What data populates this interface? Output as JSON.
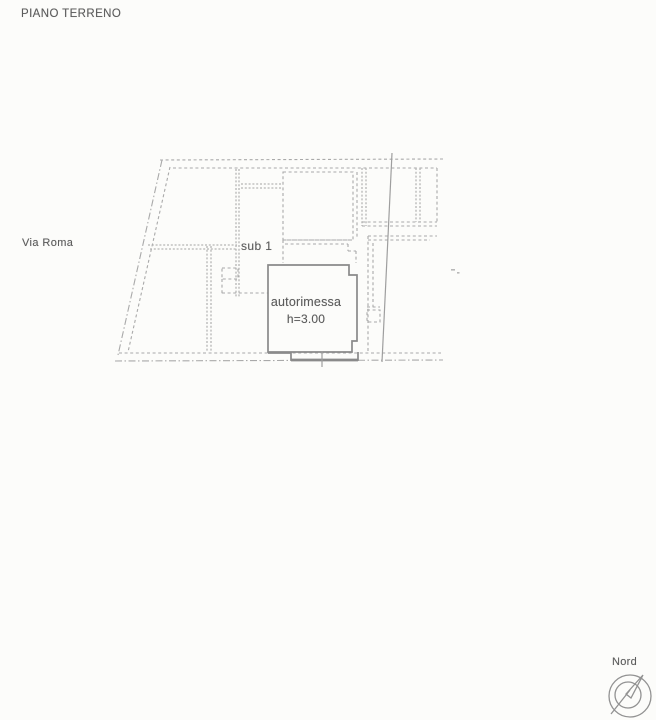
{
  "header": {
    "title": "PIANO TERRENO"
  },
  "plan": {
    "street_label": "Via Roma",
    "unit_label": "sub 1",
    "garage": {
      "name": "autorimessa",
      "height": "h=3.00"
    }
  },
  "compass": {
    "label": "Nord"
  },
  "colors": {
    "background": "#fcfcfa",
    "line_dashed": "#a9a9a9",
    "line_dense": "#b5b5b5",
    "wall_solid": "#8a8a8a",
    "line_solid_thin": "#9e9e9e",
    "text": "#5c5c5c"
  }
}
